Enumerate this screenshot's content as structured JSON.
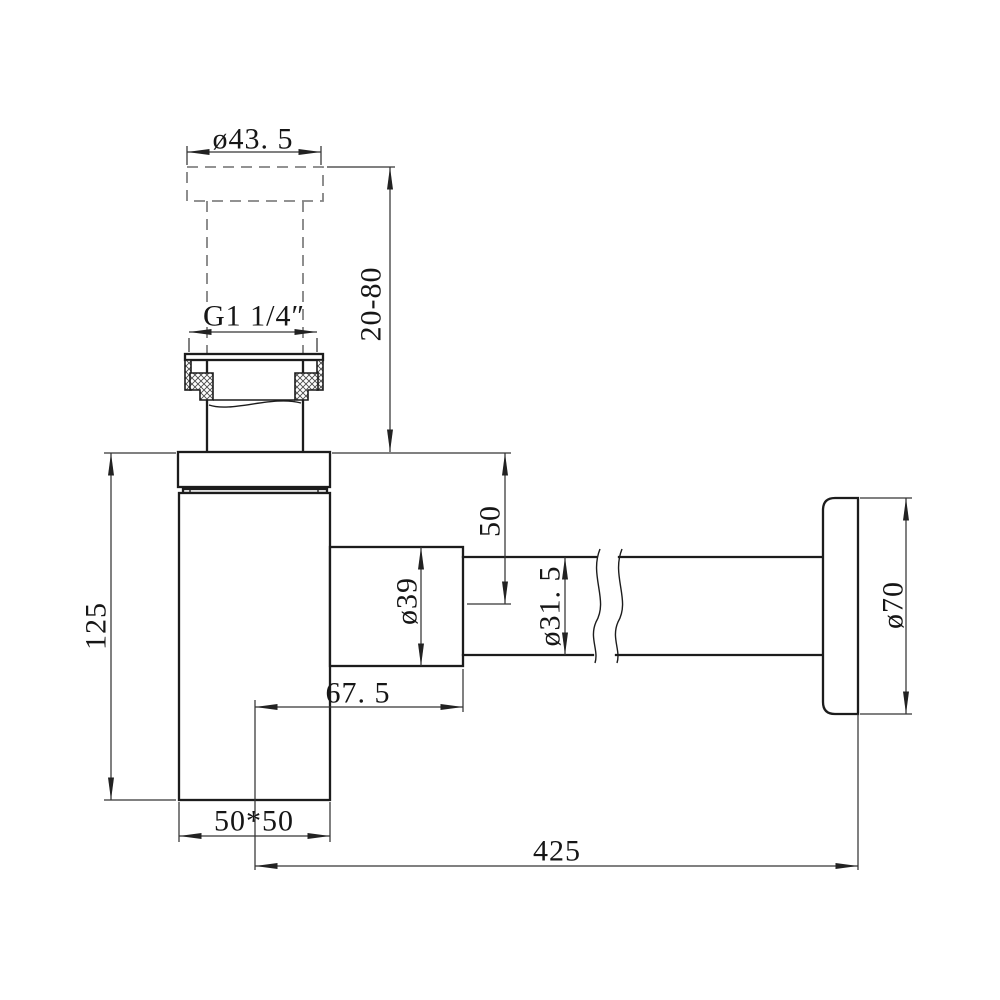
{
  "drawing": {
    "type": "technical-dimension-drawing",
    "subject": "bottle trap siphon with wall flange, sectioned slip nut and break lines",
    "background_color": "#ffffff",
    "line_color": "#1c1c1c",
    "dashed_line_color": "#828282",
    "labels": {
      "cap_diameter": "ø43. 5",
      "thread_size": "G1 1/4″",
      "inlet_height_range": "20-80",
      "body_height": "125",
      "inlet_to_outlet_center": "50",
      "outlet_nut_diameter": "ø39",
      "outlet_pipe_diameter": "ø31. 5",
      "wall_flange_diameter": "ø70",
      "outlet_length": "67. 5",
      "body_section": "50*50",
      "overall_length": "425"
    }
  }
}
